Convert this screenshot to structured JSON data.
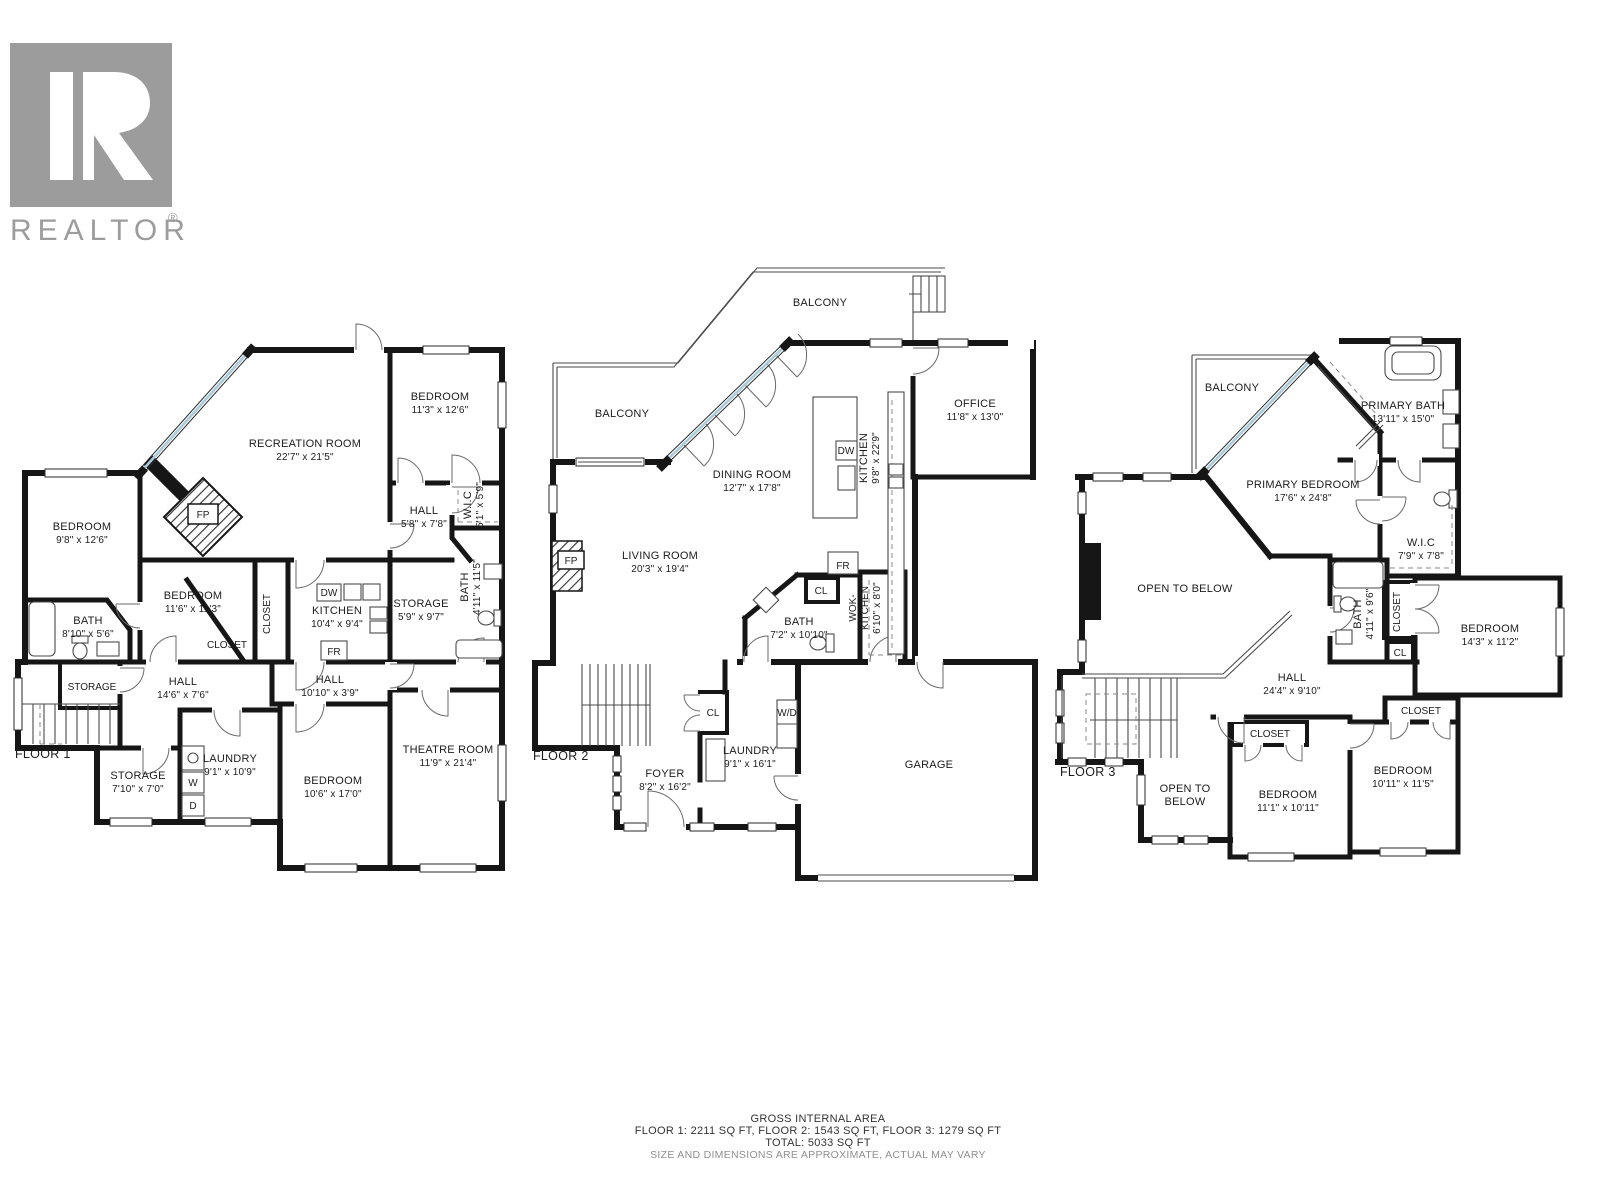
{
  "logo": {
    "brand": "REALTOR",
    "reg": "®"
  },
  "floors": [
    {
      "label": "FLOOR 1",
      "rooms": [
        {
          "label": "RECREATION ROOM",
          "dims": "22'7\" x 21'5\""
        },
        {
          "label": "BEDROOM",
          "dims": "11'3\" x 12'6\""
        },
        {
          "label": "BEDROOM",
          "dims": "9'8\" x 12'6\""
        },
        {
          "label": "HALL",
          "dims": "5'8\" x 7'8\""
        },
        {
          "label": "W.I.C",
          "dims": "5'1\" x 5'9\""
        },
        {
          "label": "FP"
        },
        {
          "label": "BEDROOM",
          "dims": "11'6\" x 11'3\""
        },
        {
          "label": "CLOSET"
        },
        {
          "label": "CLOSET"
        },
        {
          "label": "KITCHEN",
          "dims": "10'4\" x 9'4\""
        },
        {
          "label": "DW"
        },
        {
          "label": "FR"
        },
        {
          "label": "STORAGE",
          "dims": "5'9\" x 9'7\""
        },
        {
          "label": "BATH",
          "dims": "4'11\" x 11'5\""
        },
        {
          "label": "BATH",
          "dims": "8'10\" x 5'6\""
        },
        {
          "label": "STORAGE"
        },
        {
          "label": "HALL",
          "dims": "14'6\" x 7'6\""
        },
        {
          "label": "HALL",
          "dims": "10'10\" x 3'9\""
        },
        {
          "label": "STORAGE",
          "dims": "7'10\" x 7'0\""
        },
        {
          "label": "LAUNDRY",
          "dims": "9'1\" x 10'9\""
        },
        {
          "label": "W"
        },
        {
          "label": "D"
        },
        {
          "label": "BEDROOM",
          "dims": "10'6\" x 17'0\""
        },
        {
          "label": "THEATRE ROOM",
          "dims": "11'9\" x 21'4\""
        }
      ]
    },
    {
      "label": "FLOOR 2",
      "rooms": [
        {
          "label": "BALCONY"
        },
        {
          "label": "BALCONY"
        },
        {
          "label": "DINING ROOM",
          "dims": "12'7\" x 17'8\""
        },
        {
          "label": "KITCHEN",
          "dims": "9'8\" x 22'9\""
        },
        {
          "label": "DW"
        },
        {
          "label": "OFFICE",
          "dims": "11'8\" x 13'0\""
        },
        {
          "label": "LIVING ROOM",
          "dims": "20'3\" x 19'4\""
        },
        {
          "label": "FP"
        },
        {
          "label": "FR"
        },
        {
          "label": "CL"
        },
        {
          "label": "BATH",
          "dims": "7'2\" x 10'10\""
        },
        {
          "line1": "WOK-",
          "line2": "KITCHEN",
          "dims": "6'10\" x 8'0\""
        },
        {
          "label": "CL"
        },
        {
          "label": "W/D"
        },
        {
          "label": "LAUNDRY",
          "dims": "9'1\" x 16'1\""
        },
        {
          "label": "FOYER",
          "dims": "8'2\" x 16'2\""
        },
        {
          "label": "GARAGE"
        }
      ]
    },
    {
      "label": "FLOOR 3",
      "rooms": [
        {
          "label": "BALCONY"
        },
        {
          "label": "PRIMARY BATH",
          "dims": "13'11\" x 15'0\""
        },
        {
          "label": "PRIMARY BEDROOM",
          "dims": "17'6\" x 24'8\""
        },
        {
          "label": "W.I.C",
          "dims": "7'9\" x 7'8\""
        },
        {
          "label": "OPEN TO BELOW"
        },
        {
          "label": "BATH",
          "dims": "4'11\" x 9'6\""
        },
        {
          "label": "CLOSET"
        },
        {
          "label": "CL"
        },
        {
          "label": "BEDROOM",
          "dims": "14'3\" x 11'2\""
        },
        {
          "label": "HALL",
          "dims": "24'4\" x 9'10\""
        },
        {
          "label": "CLOSET"
        },
        {
          "label": "CLOSET"
        },
        {
          "line1": "OPEN TO",
          "line2": "BELOW"
        },
        {
          "label": "BEDROOM",
          "dims": "11'1\" x 10'11\""
        },
        {
          "label": "BEDROOM",
          "dims": "10'11\" x 11'5\""
        }
      ]
    }
  ],
  "footer": {
    "line1": "GROSS INTERNAL AREA",
    "line2": "FLOOR 1: 2211 SQ FT, FLOOR 2: 1543 SQ FT, FLOOR 3: 1279 SQ FT",
    "line3": "TOTAL: 5033 SQ FT",
    "line4": "SIZE AND DIMENSIONS ARE APPROXIMATE, ACTUAL MAY VARY"
  },
  "colors": {
    "wall": "#161616",
    "window_glass": "#a9cbdb",
    "logo_gray": "#9c9c9c",
    "text": "#1c1c1c",
    "muted_text": "#8f8f8f"
  }
}
